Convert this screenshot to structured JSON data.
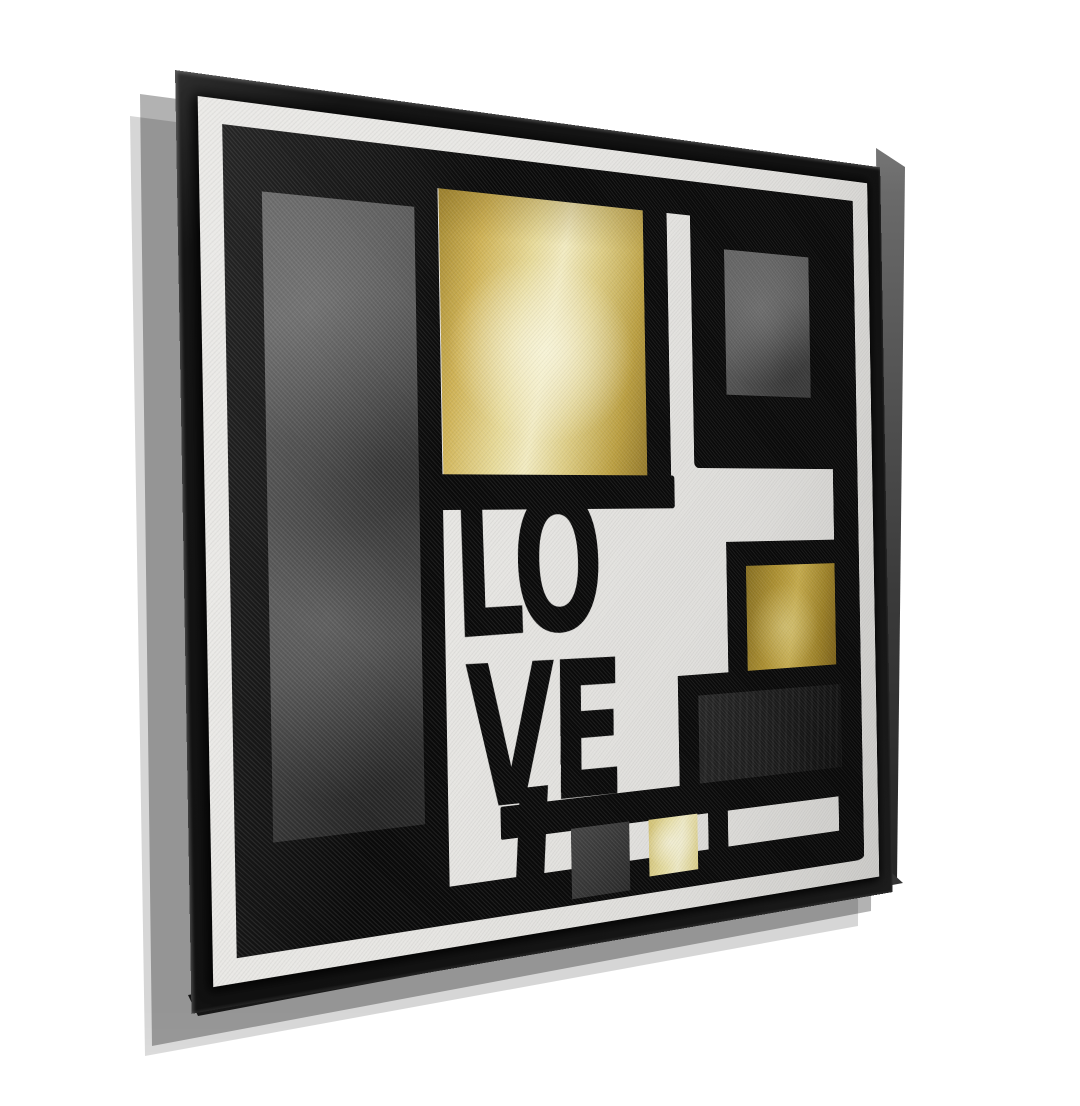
{
  "artwork": {
    "word": "LOVE",
    "line1": "LO",
    "line2": "VE"
  },
  "palette": {
    "wall": "#ffffff",
    "frame": "#121212",
    "frame_edge_light": "#969696",
    "canvas": "#e8e7e4",
    "canvas_margin": "#f3f2ef",
    "paint": "#0a0a0a",
    "gray_column": "#434343",
    "gray_square": "#5d5d5d",
    "charcoal": "#1c1c1c",
    "dark_small": "#383838",
    "gold_deep": "#a2862c",
    "gold": "#d3b752",
    "gold_light": "#f5eec4",
    "pale_gold": "#efe6aa"
  }
}
